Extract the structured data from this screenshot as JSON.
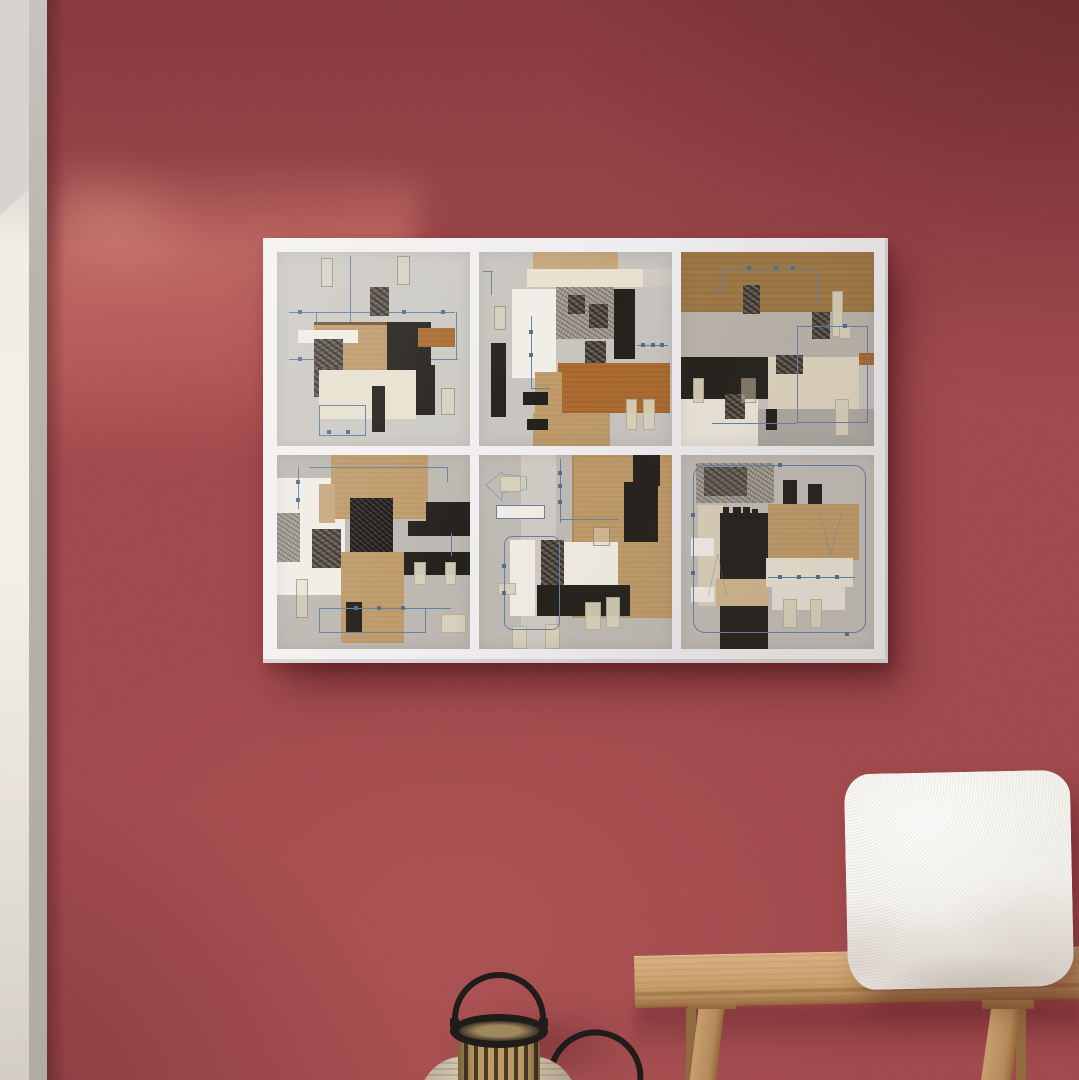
{
  "meta": {
    "type": "photograph",
    "description": "Interior photo: a six-panel abstract paper-collage art print on a white canvas hangs on a textured dark red plaster wall lit by diagonal window light from the upper left; below sit a white boucle cushion on a light oak bench and a wooden slatted candle lantern with a black metal handle."
  },
  "colors": {
    "wall": "#9d474a",
    "wallshadow": "#5e1f24",
    "walllight": "#c86a66",
    "canvas": "#f1efec",
    "panel": "#c5c1bb",
    "kraft": "#bd9766",
    "sienna": "#a8672e",
    "brown": "#9a7443",
    "blackpaper": "#23201c",
    "cream": "#e7e0cf",
    "tape": "#d9d1b9",
    "blueline": "#5f7ba0",
    "wood": "#c49a6b",
    "pillow": "#f2f0ea",
    "metal": "#1d1a18",
    "sidewall": "#f2ede5",
    "sideedge": "#b4b0a9"
  },
  "scene": {
    "wall": {
      "label": "textured red plaster wall with diagonal light beam"
    },
    "left_opening": {
      "label": "white wall corner and doorway edge at left"
    },
    "artwork": {
      "label": "six-panel abstract collage canvas print",
      "rows": 2,
      "columns": 3,
      "style": "geometric paper collage with kraft paper, black and cream papers, ink monoprints, tape strips and thin blue circuit-like lines",
      "panels": [
        {
          "id": 1,
          "label": "collage with kraft square, black block, white bar and circuit grid"
        },
        {
          "id": 2,
          "label": "collage with sienna rectangle, white column and monoprint block"
        },
        {
          "id": 3,
          "label": "collage with brown top band and black / cream quadrants"
        },
        {
          "id": 4,
          "label": "collage with kraft panels, heavy ink monoprints and stepped black shape"
        },
        {
          "id": 5,
          "label": "collage with left-pointing arrow outline, kraft half and black bar"
        },
        {
          "id": 6,
          "label": "collage with rounded blue outline, black blocks and tape strips"
        }
      ]
    },
    "pillow": {
      "label": "white boucle cushion on bench"
    },
    "bench": {
      "label": "light oak wooden bench, partially cropped at right"
    },
    "lantern": {
      "label": "wooden slatted candle lantern with black handle on round wooden base"
    },
    "second_lantern": {
      "label": "black handle of a second lantern, cropped at bottom"
    }
  }
}
